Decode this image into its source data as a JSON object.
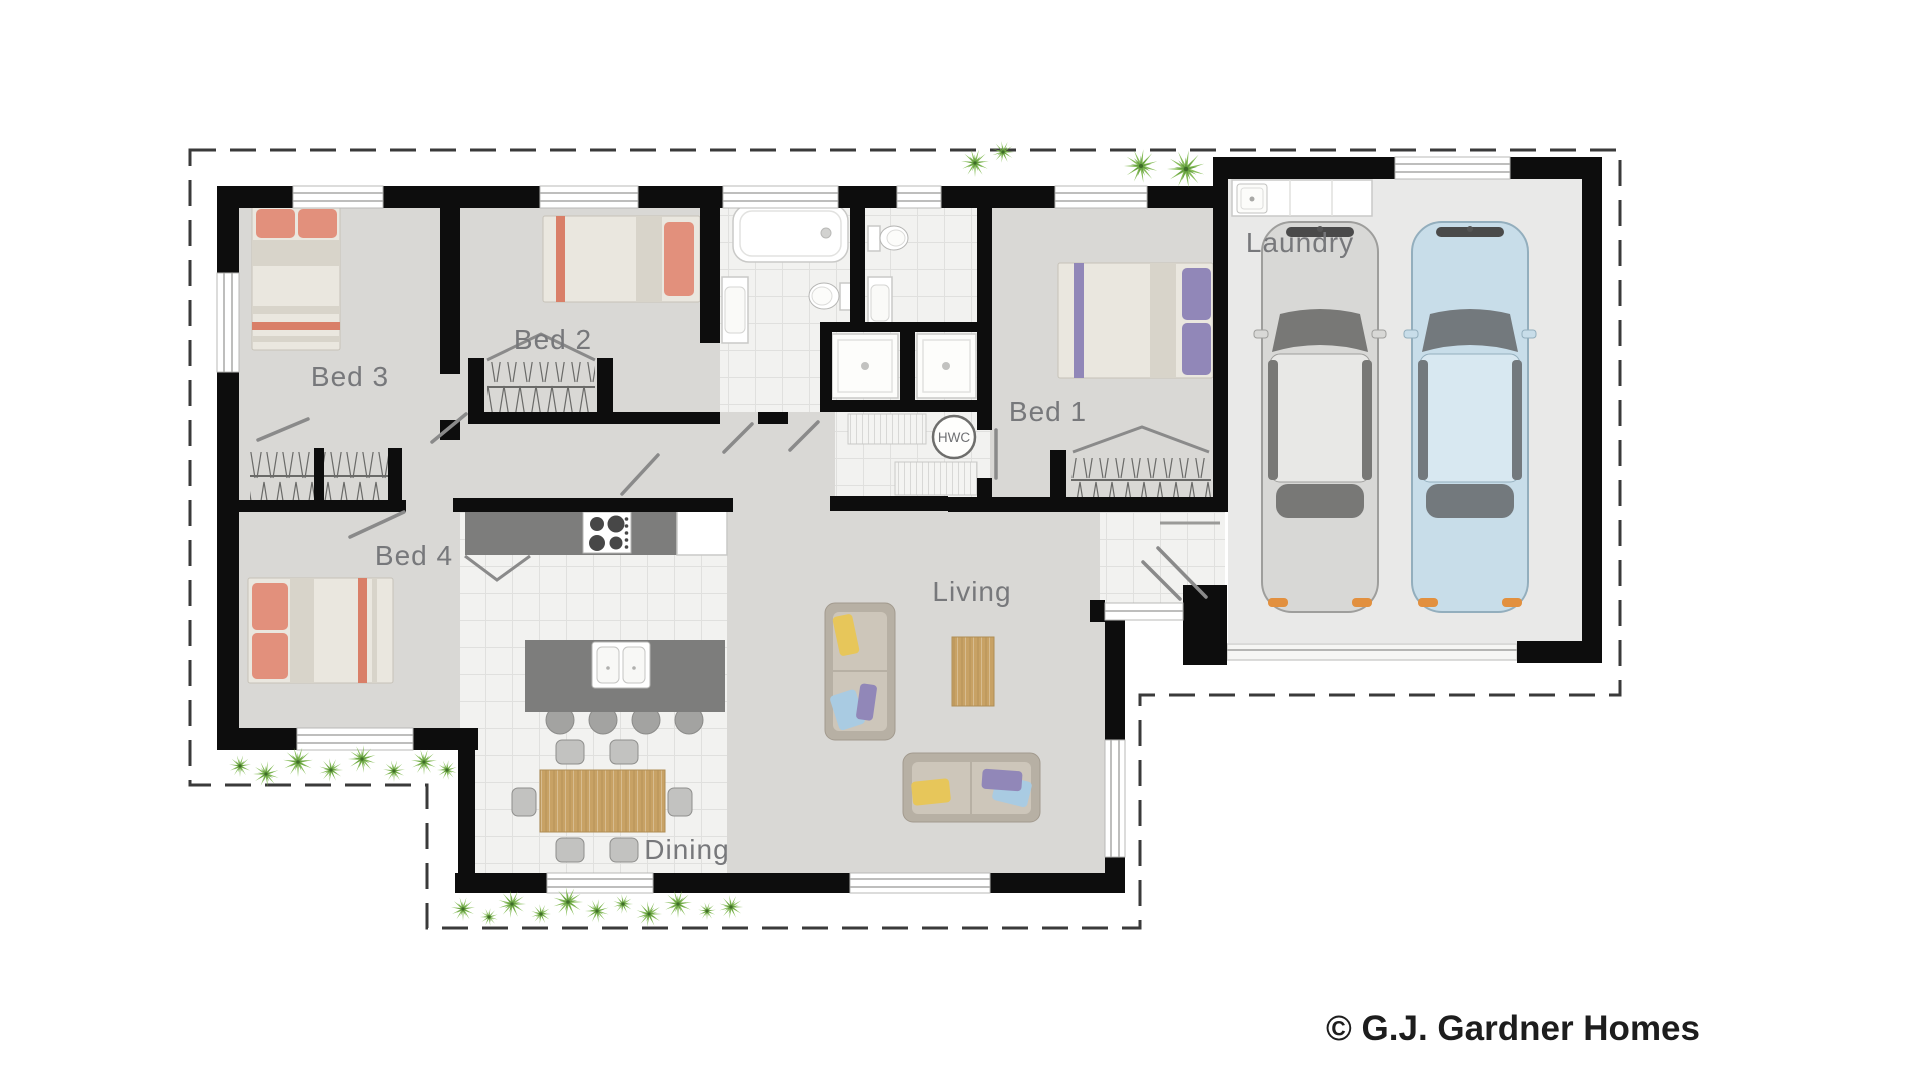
{
  "meta": {
    "copyright": "© G.J. Gardner Homes",
    "drawing_type": "floor-plan"
  },
  "rooms": {
    "laundry": {
      "label": "Laundry"
    },
    "bed1": {
      "label": "Bed 1"
    },
    "bed2": {
      "label": "Bed 2"
    },
    "bed3": {
      "label": "Bed 3"
    },
    "bed4": {
      "label": "Bed 4"
    },
    "living": {
      "label": "Living"
    },
    "dining": {
      "label": "Dining"
    }
  },
  "fixtures": {
    "hot_water_cylinder": {
      "label": "HWC"
    }
  },
  "palette": {
    "wall": "#0d0d0d",
    "floor": "#d9d8d5",
    "garage_floor": "#e9e9e8",
    "tile": "#f2f2f0",
    "bed_coral": "#e2907c",
    "bed_purple": "#9187b8",
    "counter_gray": "#7d7d7c",
    "wood": "#c8a265",
    "couch_beige": "#b7b0a4",
    "pillow_yellow": "#e7c65a",
    "pillow_blue": "#a9cbe2",
    "label_gray": "#77787b",
    "plant_green": "#7ab648",
    "car_gray": "#d8d8d6",
    "car_blue": "#c8dde9",
    "car_accent_orange": "#e2903f"
  }
}
